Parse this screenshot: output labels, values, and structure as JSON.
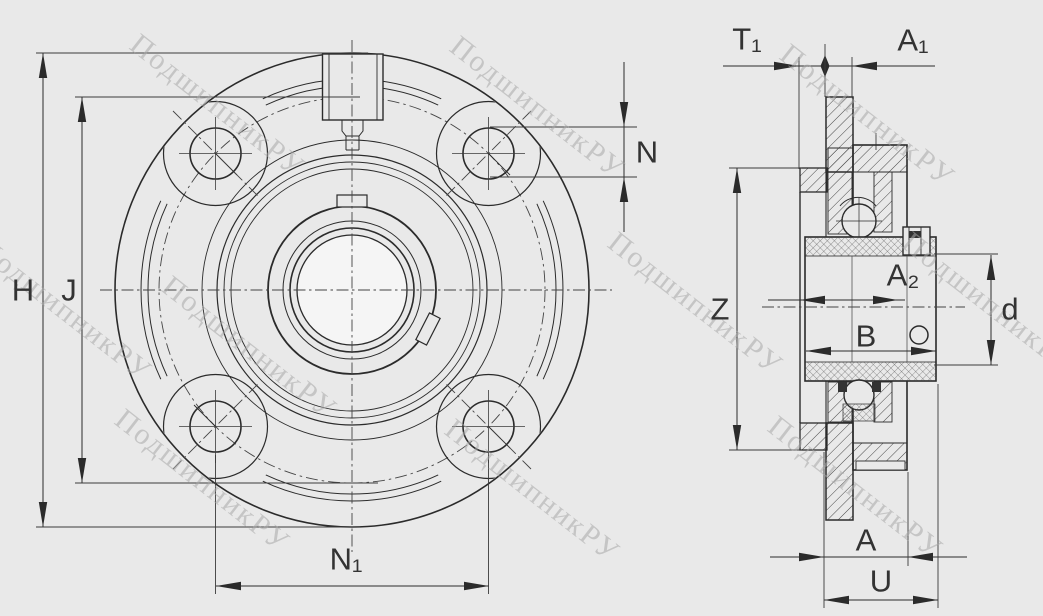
{
  "drawing": {
    "dims": {
      "H": "H",
      "J": "J",
      "N": "N",
      "N1": "N₁",
      "T1": "T₁",
      "A1": "A₁",
      "A2": "A₂",
      "Z": "Z",
      "B": "B",
      "d": "d",
      "A": "A",
      "U": "U"
    },
    "watermark_text": "ПодшипникРУ",
    "colors": {
      "background": "#e9e9e9",
      "line": "#2b2b2b",
      "watermark": "#a8a8a8",
      "bore_fill": "#f5f5f5"
    }
  }
}
